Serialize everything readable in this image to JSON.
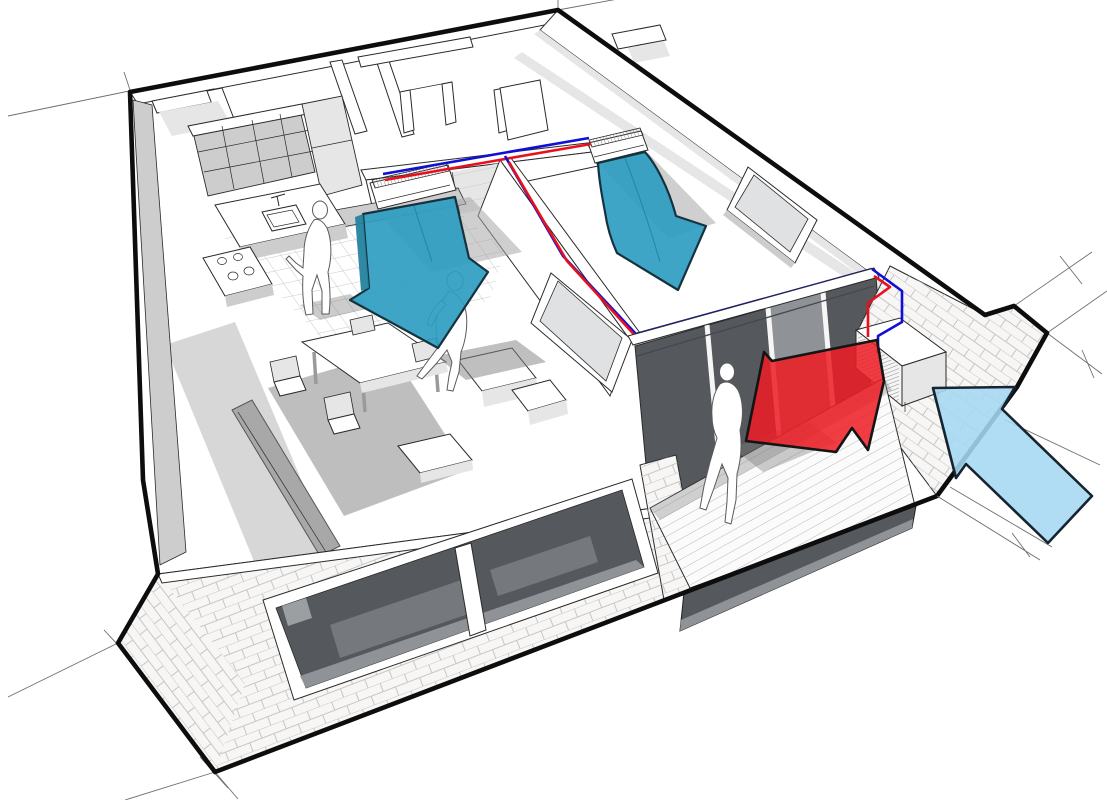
{
  "meta": {
    "description": "Perspective cutaway diagram of a one-bedroom apartment with wall mounted split air conditioning: two indoor units blowing cool air (teal arrows), refrigerant pipes (red hot line, blue cold line) running along interior walls to an outdoor condenser unit on the balcony brick wall, with red heat-exhaust arrow and light blue outside-air intake arrow",
    "style": "technical 3D line illustration, no visible text"
  },
  "colors": {
    "background": "#ffffff",
    "line": "#2a2a2a",
    "outline": "#0d0d0d",
    "gray_1": "#e6e6e6",
    "gray_2": "#cdcdcd",
    "gray_3": "#a8a8a8",
    "gray_4": "#8f8f8f",
    "glass_dark": "#55585c",
    "glass_mid": "#8f9397",
    "glass_light": "#dfe1e2",
    "mortar": "#c6c6c6",
    "tile_line": "#c9c9c9",
    "plank_line": "#b9b9b9",
    "cool_arrow": "#2f9dc1",
    "cool_arrow_dark": "#25839f",
    "warm_arrow": "#ed1c24",
    "intake_arrow": "#a5d8f3",
    "pipe_hot": "#e8101c",
    "pipe_cold": "#0f0fd6",
    "figure": "#ffffff",
    "shadow": "#7f7f7f"
  },
  "elements": {
    "rooms": [
      "kitchen",
      "hallway",
      "bathroom",
      "living-room",
      "bedroom",
      "balcony"
    ],
    "indoor_unit_living": {
      "type": "wall-mounted split indoor unit",
      "room": "living-room"
    },
    "indoor_unit_bedroom": {
      "type": "wall-mounted split indoor unit",
      "room": "bedroom"
    },
    "outdoor_unit": {
      "type": "condenser unit",
      "location": "balcony side brick wall"
    },
    "pipes": [
      {
        "name": "refrigerant-line-hot",
        "color_key": "pipe_hot"
      },
      {
        "name": "refrigerant-line-cold",
        "color_key": "pipe_cold"
      }
    ],
    "arrows": [
      {
        "name": "cool-airflow-living-room",
        "color_key": "cool_arrow",
        "direction": "down"
      },
      {
        "name": "cool-airflow-bedroom",
        "color_key": "cool_arrow",
        "direction": "down"
      },
      {
        "name": "heat-exhaust",
        "color_key": "warm_arrow",
        "direction": "left toward balcony"
      },
      {
        "name": "outside-air-intake",
        "color_key": "intake_arrow",
        "direction": "up-left toward outdoor unit"
      }
    ],
    "figures": [
      {
        "name": "person-kitchen",
        "pose": "standing at counter"
      },
      {
        "name": "person-living-room",
        "pose": "walking"
      },
      {
        "name": "person-balcony",
        "pose": "walking"
      }
    ]
  }
}
